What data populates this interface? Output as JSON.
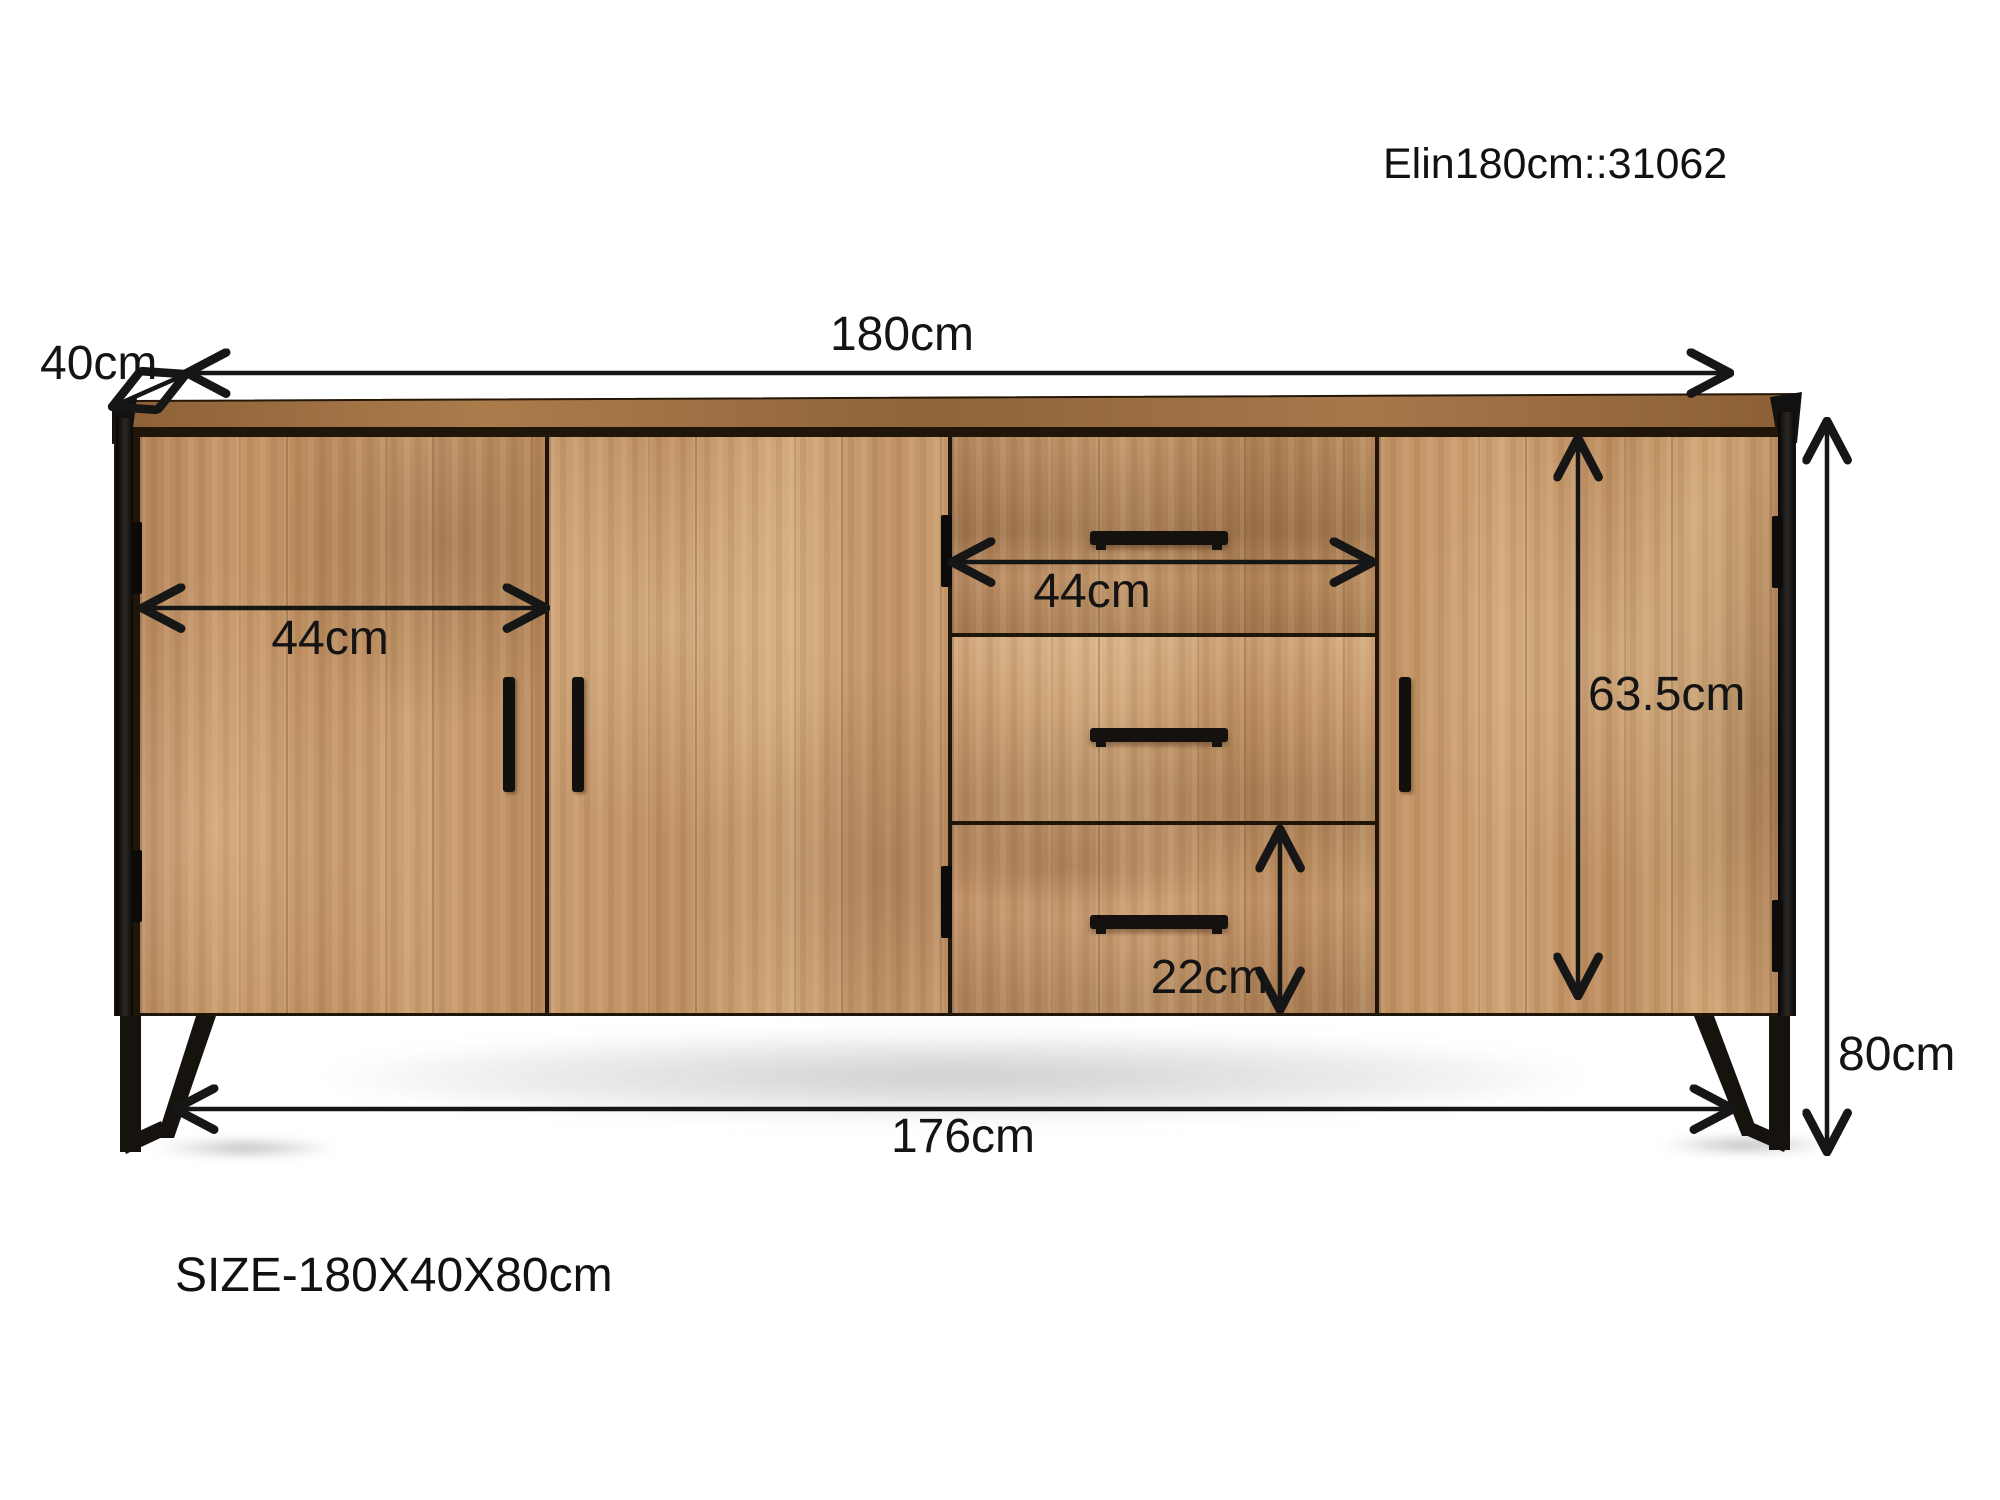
{
  "product": {
    "code": "Elin180cm::31062",
    "size_caption": "SIZE-180X40X80cm"
  },
  "dimensions": {
    "top_width": "180cm",
    "depth": "40cm",
    "left_door_width": "44cm",
    "drawer_width": "44cm",
    "bottom_drawer_height": "22cm",
    "door_height": "63.5cm",
    "overall_height": "80cm",
    "base_width": "176cm"
  },
  "colors": {
    "annotation": "#161616",
    "wood_light": "#d2a97c",
    "wood_mid": "#c2936a",
    "wood_dark": "#9a6f45",
    "metal_frame": "#16120e",
    "background": "#ffffff"
  }
}
